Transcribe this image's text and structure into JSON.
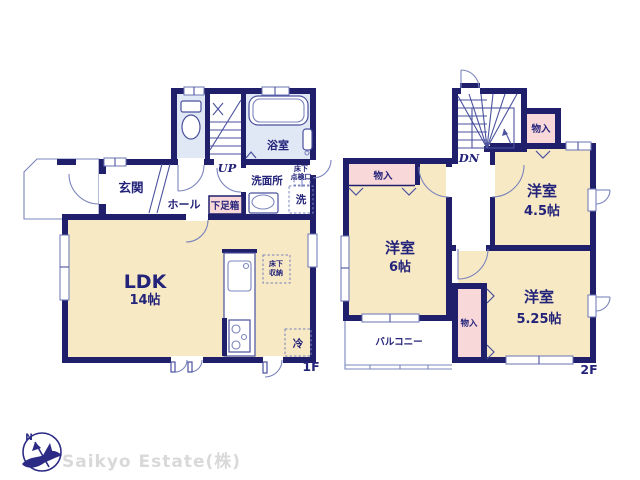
{
  "colors": {
    "wall": "#1f1f6b",
    "room_cream": "#f8e9c5",
    "room_blue": "#e0e8f5",
    "closet_pink": "#f9d8da",
    "text_navy": "#23237a",
    "company_gray": "#d9d9d9"
  },
  "floor1": {
    "label": "1F",
    "entrance": "玄関",
    "hall": "ホール",
    "shoe_box": "下足箱",
    "bathroom": "浴室",
    "washroom": "洗面所",
    "up": "UP",
    "ldk_name": "LDK",
    "ldk_size": "14帖",
    "underfloor_storage_line1": "床下",
    "underfloor_storage_line2": "収納",
    "inspection_line1": "床下",
    "inspection_line2": "点検口",
    "washer": "洗",
    "fridge": "冷"
  },
  "floor2": {
    "label": "2F",
    "down": "DN",
    "closet_top": "物入",
    "closet_left": "物入",
    "closet_middle": "物入",
    "room6_name": "洋室",
    "room6_size": "6帖",
    "room45_name": "洋室",
    "room45_size": "4.5帖",
    "room525_name": "洋室",
    "room525_size": "5.25帖",
    "balcony": "バルコニー"
  },
  "footer": {
    "company": "Saikyo Estate(株)",
    "compass_north": "N"
  }
}
